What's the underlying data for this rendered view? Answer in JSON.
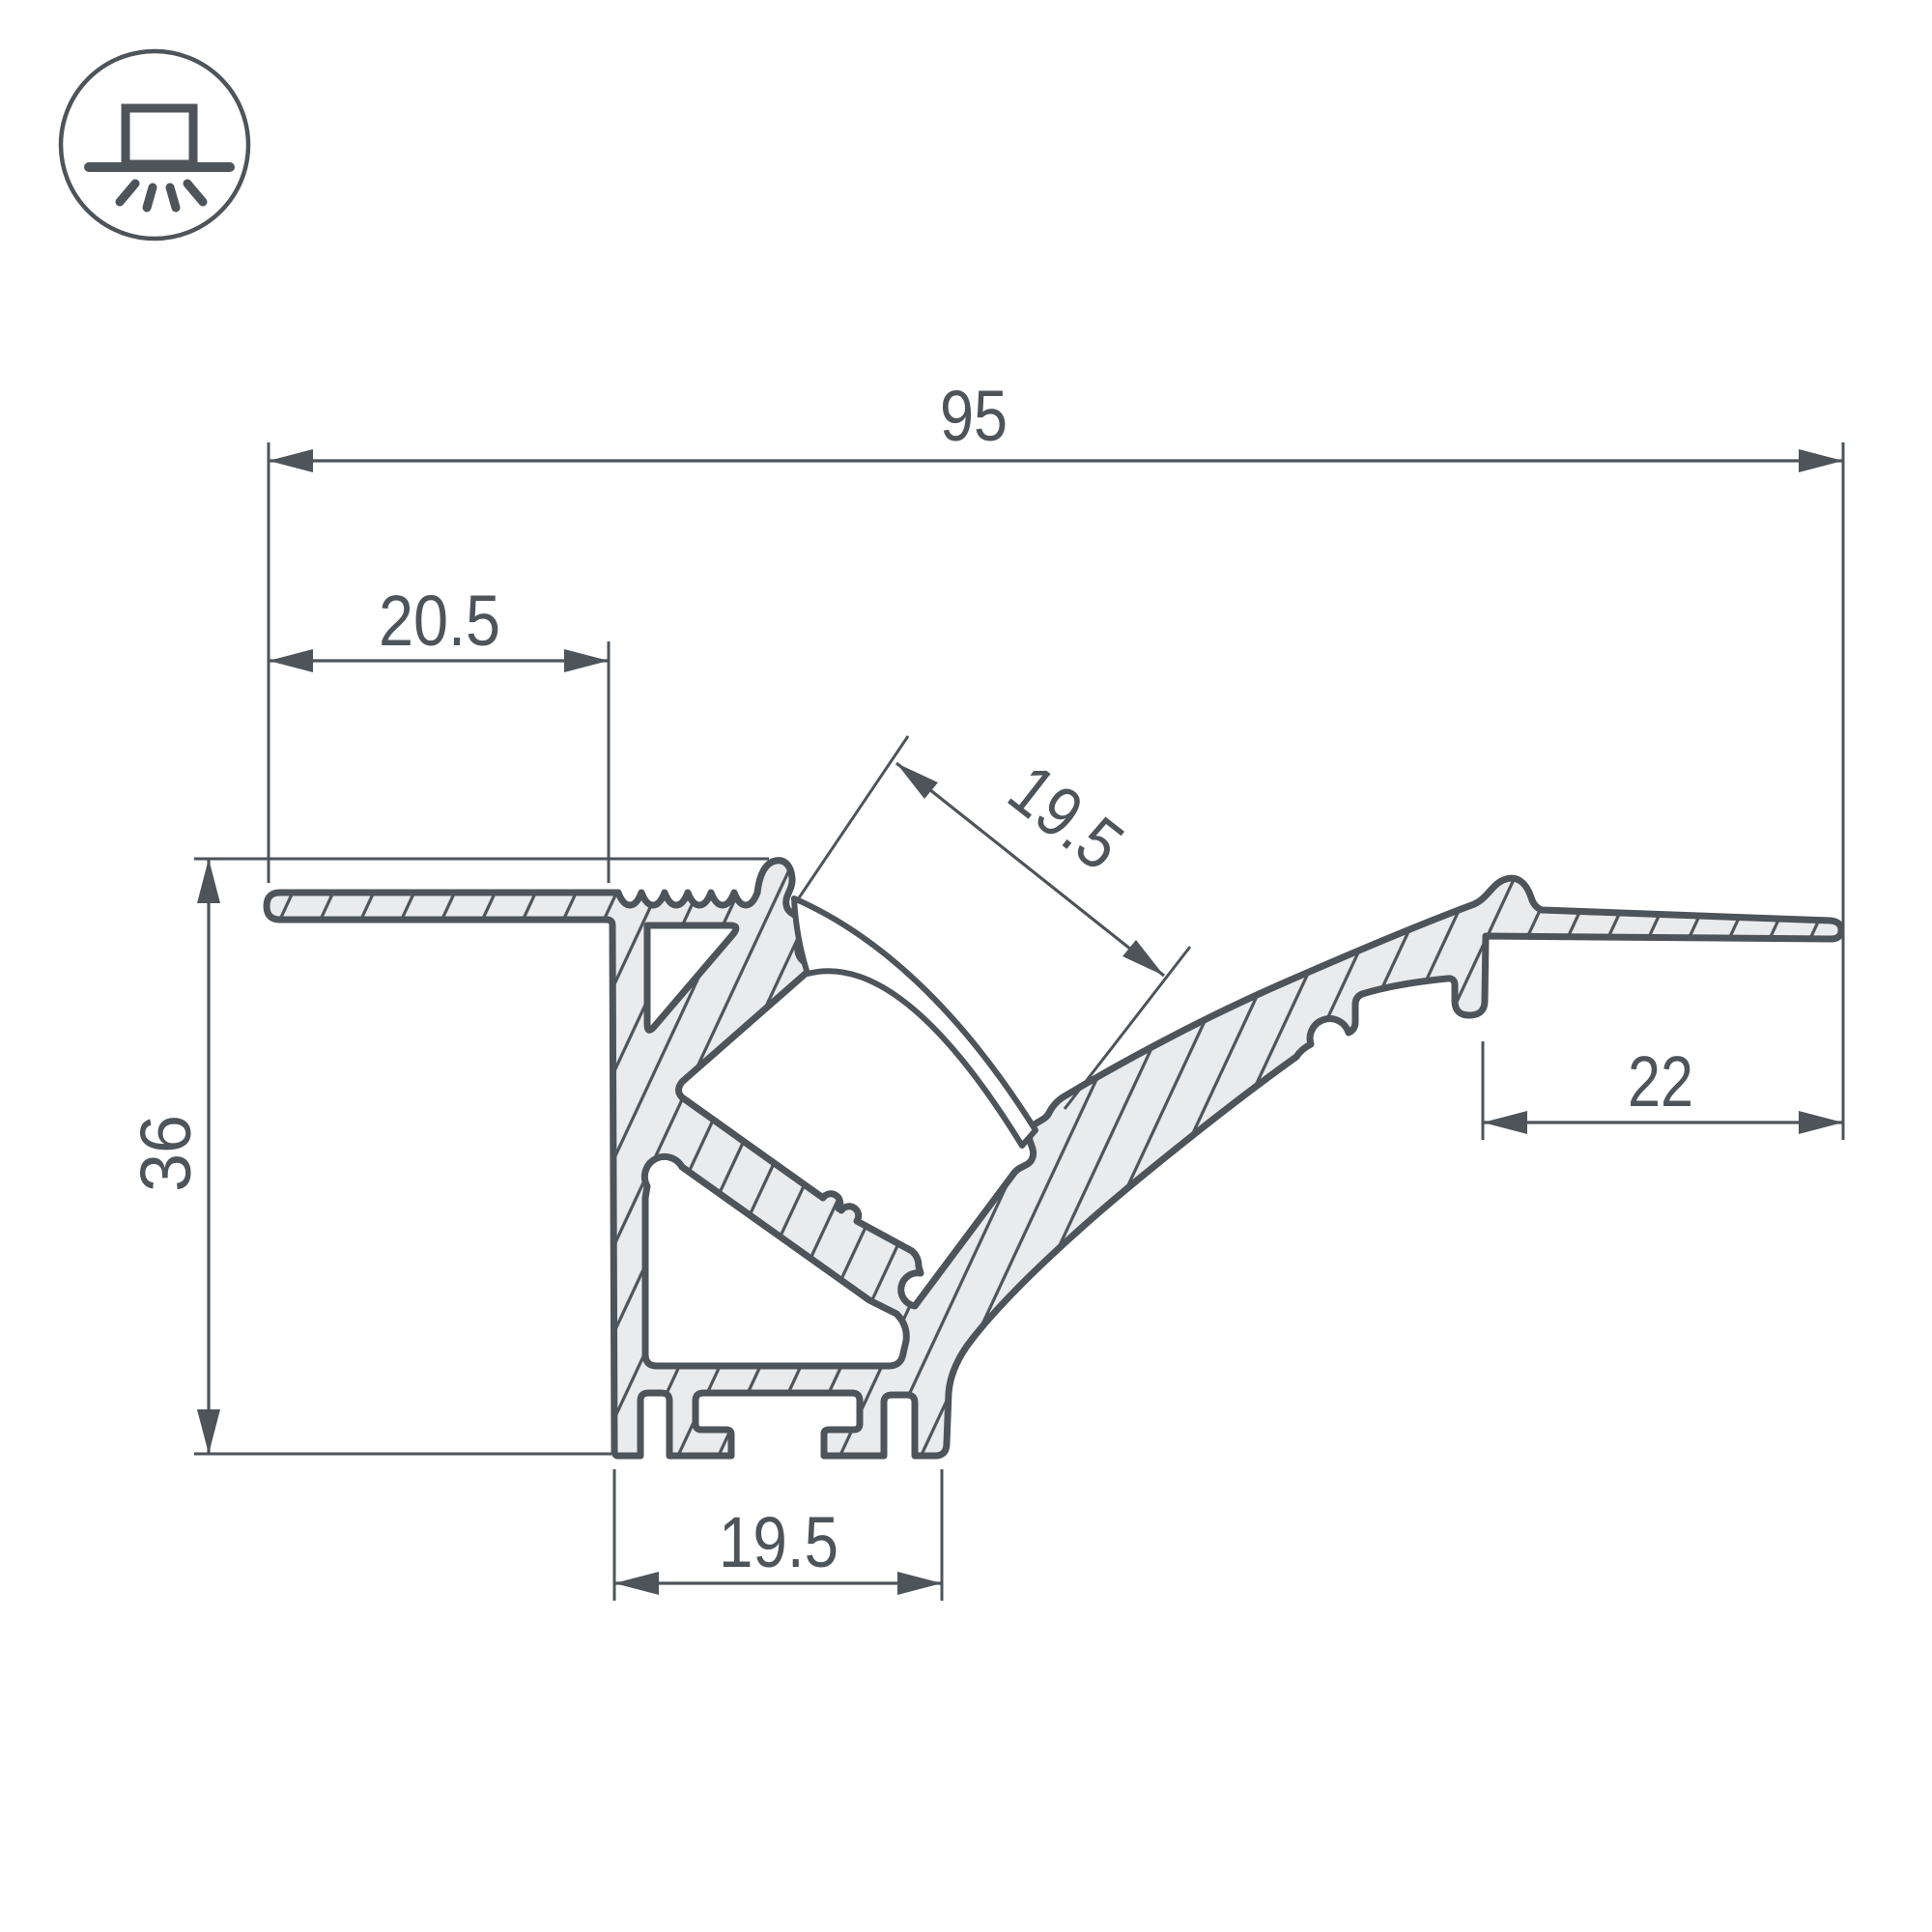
{
  "icon": {
    "name": "surface-mounted-light-icon"
  },
  "dimensions": {
    "total_width": "95",
    "left_flange_width": "20.5",
    "channel_width": "19.5",
    "height": "36",
    "right_flange_width": "22",
    "base_width": "19.5"
  },
  "colors": {
    "line": "#4d545a",
    "aluminum_fill": "#e9ebec",
    "background": "#ffffff"
  }
}
